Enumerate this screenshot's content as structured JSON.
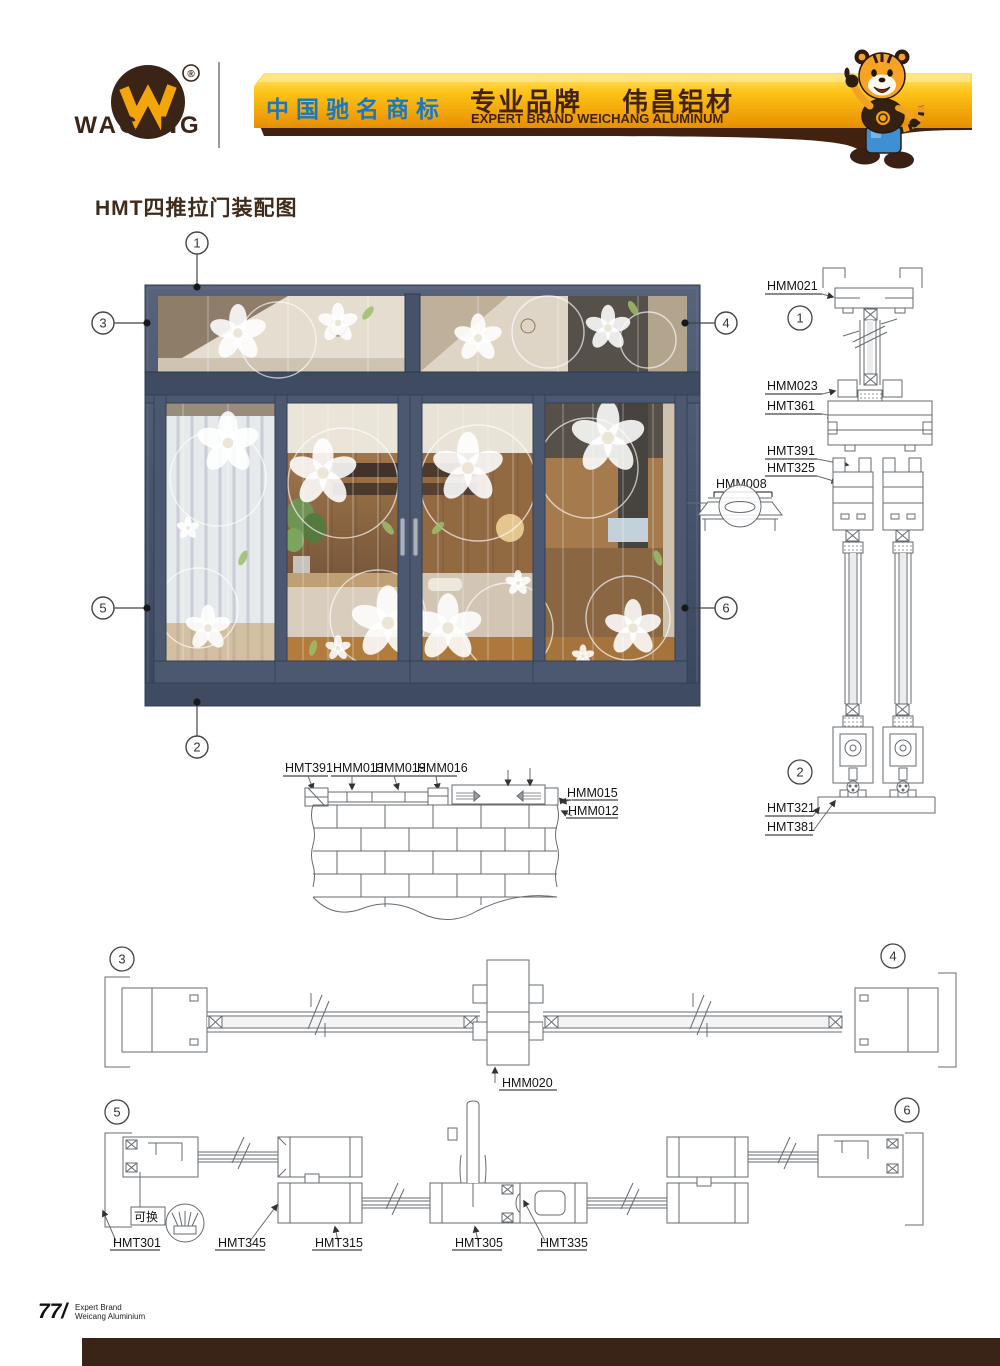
{
  "header": {
    "logo": {
      "name": "WACANG",
      "registered": "®"
    },
    "banner": {
      "cn_badge": "中国驰名商标",
      "brand_cn": "专业品牌",
      "company_cn": "伟昌铝材",
      "brand_en": "EXPERT BRAND WEICHANG ALUMINUM"
    },
    "colors": {
      "gold": "#fdc51a",
      "gold_dark": "#ef9400",
      "brown": "#42220e",
      "blue": "#1778c3"
    }
  },
  "title": "HMT四推拉门装配图",
  "door": {
    "frame_color": "#4a566c",
    "callouts": {
      "n1": "1",
      "n2": "2",
      "n3": "3",
      "n4": "4",
      "n5": "5",
      "n6": "6"
    },
    "handle_detail_label": "HMM008"
  },
  "vertical_section": {
    "callout_top": "1",
    "callout_bottom": "2",
    "l_hmm021": "HMM021",
    "l_hmm023": "HMM023",
    "l_hmt361": "HMT361",
    "l_hmt311": "HMT311",
    "l_hmt391": "HMT391",
    "l_hmt325": "HMT325",
    "l_hmt321": "HMT321",
    "l_hmt381": "HMT381"
  },
  "sill_detail": {
    "l_hmt391": "HMT391",
    "l_hmm013": "HMM013",
    "l_hmm019": "HMM019",
    "l_hmm016": "HMM016",
    "l_hmm015": "HMM015",
    "l_hmm012": "HMM012"
  },
  "horizontal_section_top": {
    "callout_left": "3",
    "callout_right": "4",
    "l_hmm020": "HMM020"
  },
  "horizontal_section_bottom": {
    "callout_left": "5",
    "callout_right": "6",
    "replaceable": "可换",
    "l_hmt301": "HMT301",
    "l_hmt345": "HMT345",
    "l_hmt315": "HMT315",
    "l_hmt305": "HMT305",
    "l_hmt335": "HMT335"
  },
  "footer": {
    "page": "77",
    "slash": "/",
    "line1": "Expert Brand",
    "line2": "Weicang Aluminium"
  }
}
